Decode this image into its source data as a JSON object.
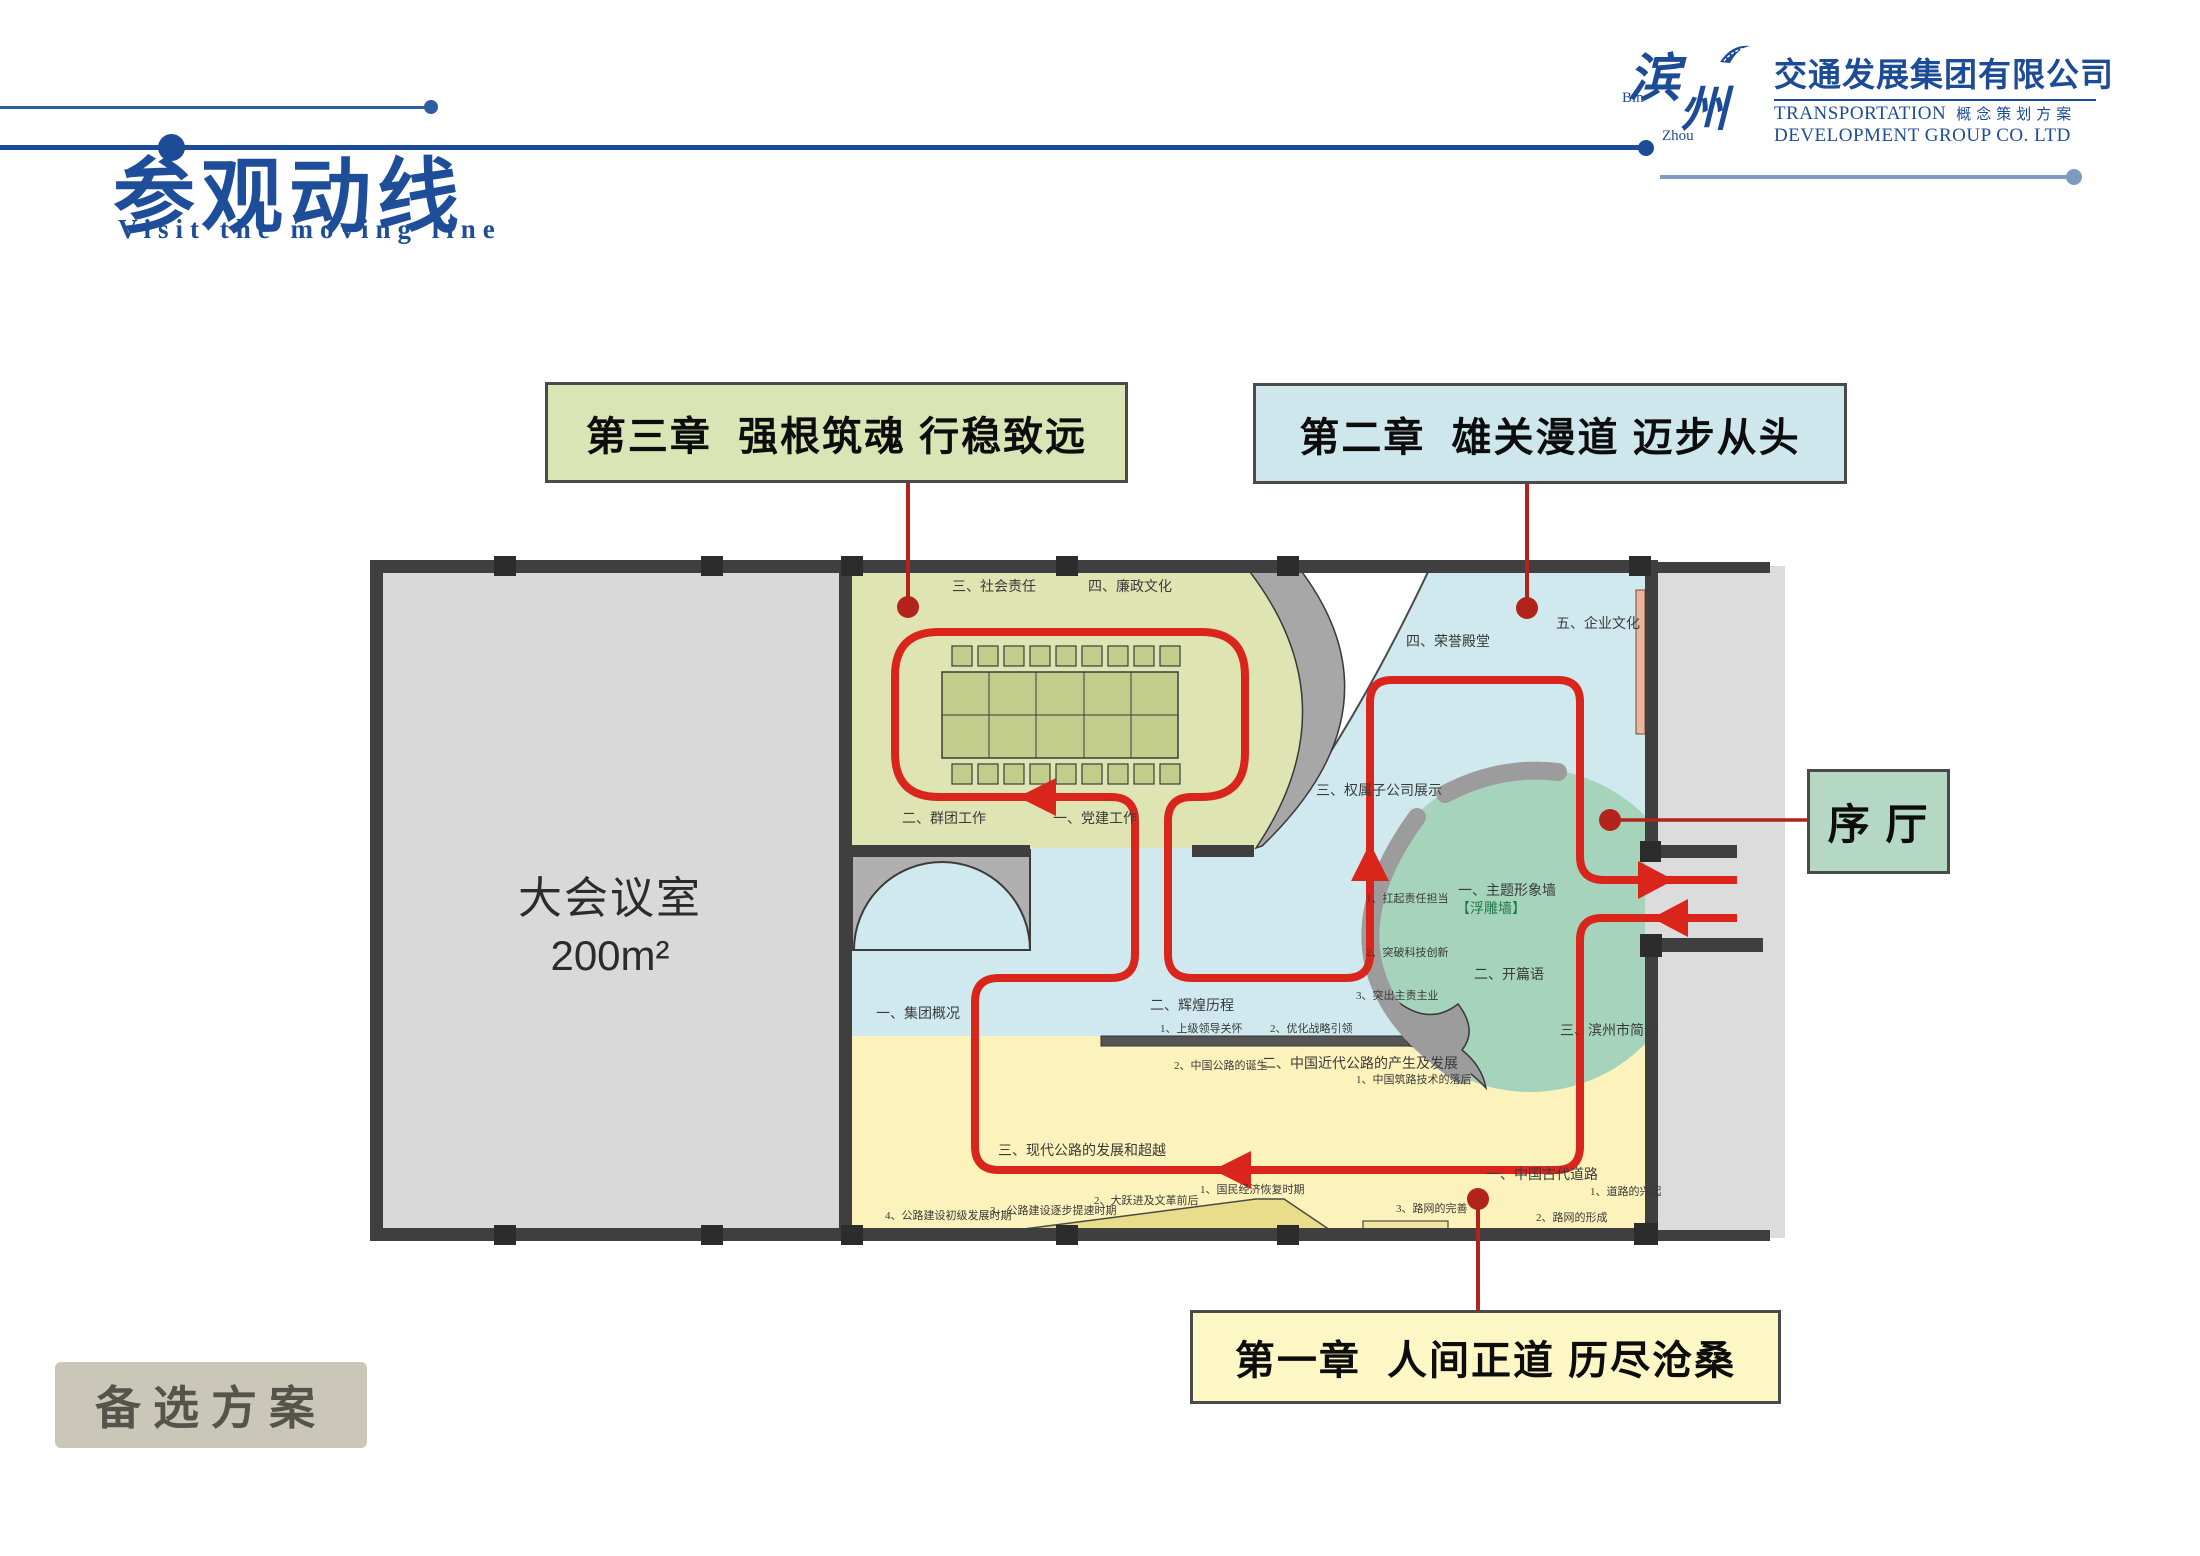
{
  "colors": {
    "brand_blue": "#1c4b97",
    "route_red": "#d9251c",
    "connector_red": "#b2231c",
    "zone_green": "#dfe5b2",
    "zone_blue": "#cfe9ef",
    "zone_yellow": "#fbf3bb",
    "zone_circle_green": "#a6d3bb",
    "callout3_bg": "#d9e5b4",
    "callout2_bg": "#cde7ec",
    "callout1_bg": "#fdf7c6",
    "lobby_bg": "#b5d8c4",
    "footer_bg": "#cbc7b8"
  },
  "header": {
    "logo_cn_1": "滨",
    "logo_cn_2": "州",
    "logo_en_1": "Bin",
    "logo_en_2": "Zhou",
    "company_cn": "交通发展集团有限公司",
    "company_en_1": "TRANSPORTATION",
    "company_tag": "概念策划方案",
    "company_en_2": "DEVELOPMENT GROUP CO. LTD"
  },
  "title": {
    "cn": "参观动线",
    "en": "Visit the moving line"
  },
  "callouts": {
    "chapter3": "第三章  强根筑魂 行稳致远",
    "chapter2": "第二章  雄关漫道 迈步从头",
    "chapter1": "第一章  人间正道 历尽沧桑",
    "lobby": "序 厅"
  },
  "plan": {
    "conference_room": {
      "name": "大会议室",
      "area": "200m²"
    },
    "labels": [
      {
        "text": "三、社会责任",
        "x": 952,
        "y": 576,
        "size": 14
      },
      {
        "text": "四、廉政文化",
        "x": 1088,
        "y": 576,
        "size": 14
      },
      {
        "text": "二、群团工作",
        "x": 902,
        "y": 808,
        "size": 14
      },
      {
        "text": "一、党建工作",
        "x": 1053,
        "y": 808,
        "size": 14
      },
      {
        "text": "五、企业文化",
        "x": 1556,
        "y": 613,
        "size": 14
      },
      {
        "text": "四、荣誉殿堂",
        "x": 1406,
        "y": 631,
        "size": 14
      },
      {
        "text": "三、权属子公司展示",
        "x": 1316,
        "y": 780,
        "size": 14
      },
      {
        "text": "1、扛起责任担当",
        "x": 1366,
        "y": 890,
        "size": 11
      },
      {
        "text": "2、突破科技创新",
        "x": 1366,
        "y": 944,
        "size": 11
      },
      {
        "text": "3、突出主责主业",
        "x": 1356,
        "y": 987,
        "size": 11
      },
      {
        "text": "一、集团概况",
        "x": 876,
        "y": 1003,
        "size": 14
      },
      {
        "text": "二、辉煌历程",
        "x": 1150,
        "y": 995,
        "size": 14
      },
      {
        "text": "1、上级领导关怀",
        "x": 1160,
        "y": 1020,
        "size": 11
      },
      {
        "text": "2、优化战略引领",
        "x": 1270,
        "y": 1020,
        "size": 11
      },
      {
        "text": "一、主题形象墙",
        "x": 1458,
        "y": 880,
        "size": 14
      },
      {
        "text": "【浮雕墙】",
        "x": 1456,
        "y": 898,
        "size": 14,
        "color": "#1d7a4f"
      },
      {
        "text": "二、开篇语",
        "x": 1474,
        "y": 964,
        "size": 14
      },
      {
        "text": "三、滨州市简介",
        "x": 1560,
        "y": 1020,
        "size": 14
      },
      {
        "text": "2、中国公路的诞生",
        "x": 1174,
        "y": 1057,
        "size": 11
      },
      {
        "text": "二、中国近代公路的产生及发展",
        "x": 1262,
        "y": 1053,
        "size": 14
      },
      {
        "text": "1、中国筑路技术的落后",
        "x": 1356,
        "y": 1071,
        "size": 11
      },
      {
        "text": "三、现代公路的发展和超越",
        "x": 998,
        "y": 1140,
        "size": 14
      },
      {
        "text": "1、国民经济恢复时期",
        "x": 1200,
        "y": 1181,
        "size": 11
      },
      {
        "text": "2、大跃进及文革前后",
        "x": 1094,
        "y": 1192,
        "size": 11
      },
      {
        "text": "3、公路建设逐步提速时期",
        "x": 990,
        "y": 1202,
        "size": 11
      },
      {
        "text": "4、公路建设初级发展时期",
        "x": 885,
        "y": 1207,
        "size": 11
      },
      {
        "text": "一、中国古代道路",
        "x": 1486,
        "y": 1164,
        "size": 14
      },
      {
        "text": "1、道路的兴起",
        "x": 1590,
        "y": 1183,
        "size": 11
      },
      {
        "text": "2、路网的形成",
        "x": 1536,
        "y": 1209,
        "size": 11
      },
      {
        "text": "3、路网的完善",
        "x": 1396,
        "y": 1200,
        "size": 11
      }
    ]
  },
  "footer": {
    "alt_plan": "备选方案"
  }
}
